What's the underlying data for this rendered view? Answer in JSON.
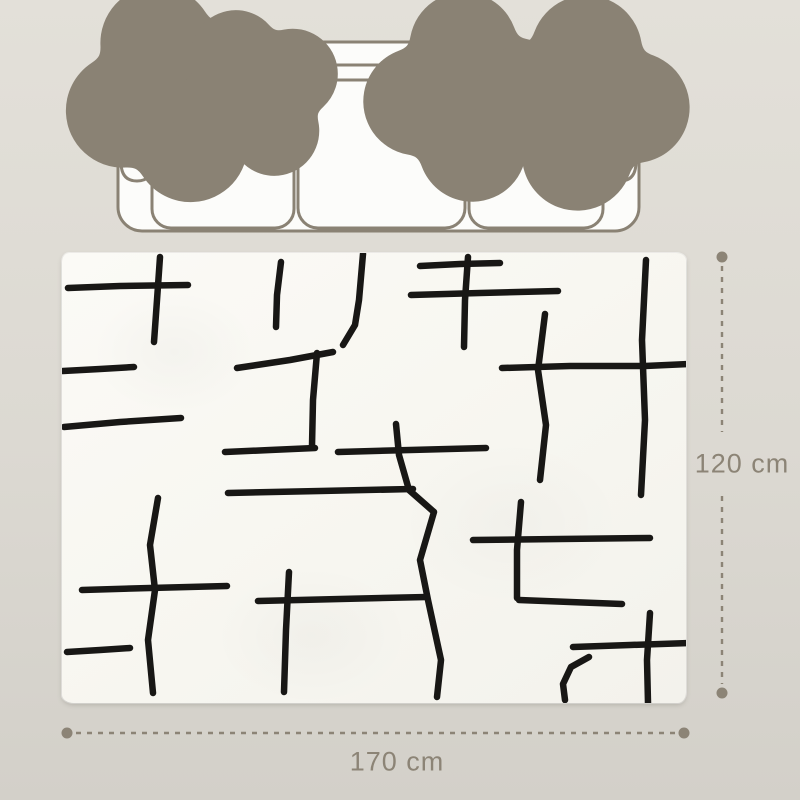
{
  "scene": {
    "name": "rug-size-diagram"
  },
  "dimensions": {
    "height_label": "120 cm",
    "width_label": "170 cm"
  },
  "colors": {
    "background_top": "#e3e0d9",
    "background_mid": "#dcd9d2",
    "background_bottom": "#d3d0c9",
    "outline": "#8a8274",
    "sofa_fill": "#fcfcfa",
    "dimension": "#8c8476",
    "rug_base": "#f8f7f1",
    "rug_line": "#181715"
  },
  "rug": {
    "pattern_strokes": [
      [
        [
          6,
          35
        ],
        [
          58,
          33
        ],
        [
          126,
          32
        ]
      ],
      [
        [
          98,
          4
        ],
        [
          95,
          47
        ],
        [
          92,
          89
        ]
      ],
      [
        [
          1,
          118
        ],
        [
          38,
          116
        ],
        [
          72,
          114
        ]
      ],
      [
        [
          2,
          174
        ],
        [
          58,
          169
        ],
        [
          119,
          165
        ]
      ],
      [
        [
          219,
          9
        ],
        [
          215,
          42
        ],
        [
          214,
          74
        ]
      ],
      [
        [
          301,
          1
        ],
        [
          297,
          47
        ],
        [
          293,
          72
        ],
        [
          281,
          92
        ]
      ],
      [
        [
          175,
          115
        ],
        [
          228,
          107
        ],
        [
          271,
          99
        ]
      ],
      [
        [
          255,
          100
        ],
        [
          251,
          147
        ],
        [
          250,
          193
        ]
      ],
      [
        [
          163,
          199
        ],
        [
          208,
          197
        ],
        [
          253,
          195
        ]
      ],
      [
        [
          276,
          199
        ],
        [
          348,
          197
        ],
        [
          424,
          195
        ]
      ],
      [
        [
          334,
          171
        ],
        [
          337,
          202
        ],
        [
          347,
          237
        ],
        [
          372,
          259
        ],
        [
          358,
          307
        ],
        [
          366,
          347
        ],
        [
          379,
          407
        ],
        [
          375,
          444
        ]
      ],
      [
        [
          166,
          240
        ],
        [
          258,
          238
        ],
        [
          351,
          236
        ]
      ],
      [
        [
          227,
          319
        ],
        [
          224,
          377
        ],
        [
          222,
          439
        ]
      ],
      [
        [
          196,
          348
        ],
        [
          278,
          346
        ],
        [
          365,
          344
        ]
      ],
      [
        [
          96,
          245
        ],
        [
          88,
          292
        ],
        [
          93,
          337
        ],
        [
          86,
          387
        ],
        [
          91,
          440
        ]
      ],
      [
        [
          20,
          337
        ],
        [
          88,
          335
        ],
        [
          165,
          333
        ]
      ],
      [
        [
          5,
          399
        ],
        [
          38,
          397
        ],
        [
          68,
          395
        ]
      ],
      [
        [
          358,
          13
        ],
        [
          398,
          11
        ],
        [
          438,
          10
        ]
      ],
      [
        [
          406,
          4
        ],
        [
          403,
          47
        ],
        [
          402,
          94
        ]
      ],
      [
        [
          349,
          42
        ],
        [
          418,
          40
        ],
        [
          496,
          38
        ]
      ],
      [
        [
          584,
          7
        ],
        [
          580,
          87
        ],
        [
          583,
          167
        ],
        [
          579,
          242
        ]
      ],
      [
        [
          440,
          115
        ],
        [
          508,
          113
        ],
        [
          583,
          113
        ],
        [
          626,
          111
        ]
      ],
      [
        [
          483,
          61
        ],
        [
          476,
          117
        ],
        [
          484,
          172
        ],
        [
          478,
          227
        ]
      ],
      [
        [
          411,
          287
        ],
        [
          498,
          286
        ],
        [
          588,
          285
        ]
      ],
      [
        [
          459,
          249
        ],
        [
          455,
          297
        ],
        [
          455,
          345
        ]
      ],
      [
        [
          457,
          347
        ],
        [
          508,
          349
        ],
        [
          560,
          351
        ]
      ],
      [
        [
          588,
          360
        ],
        [
          585,
          407
        ],
        [
          586,
          450
        ]
      ],
      [
        [
          511,
          394
        ],
        [
          568,
          392
        ],
        [
          628,
          390
        ]
      ],
      [
        [
          527,
          404
        ],
        [
          509,
          414
        ],
        [
          501,
          431
        ],
        [
          503,
          447
        ]
      ]
    ]
  }
}
